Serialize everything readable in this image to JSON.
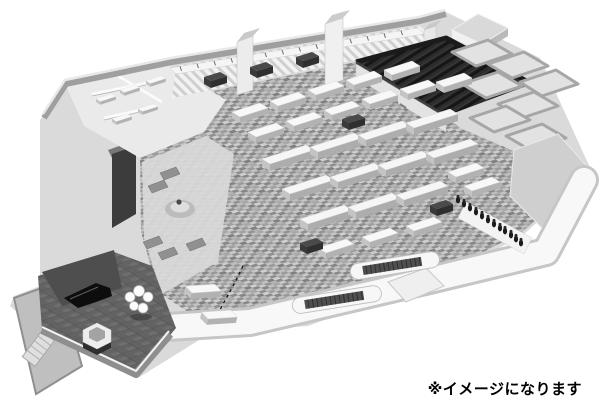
{
  "caption": {
    "text": "※イメージになります"
  },
  "scene": {
    "palette": {
      "background": "#ffffff",
      "base_silhouette": "#dadada",
      "floor_mosaic_base": "#a6a6a6",
      "floor_office": "#eaeaea",
      "floor_lounge": "#d9d9d9",
      "wall_outer": "#9f9f9f",
      "wall_top_highlight": "#e8e8e8",
      "theater_dark": "#2c2c2c",
      "plaza_dark": "#636363",
      "stage_dark": "#4e4e4e",
      "piano_black": "#0d0d0d",
      "walkway_white": "#f8f8f8",
      "walkway_edge": "#c6c6c6",
      "escalator_tread": "#4f4f4f",
      "roof_gray": "#cfcfcf",
      "dark_shelf": "#3c3c3c",
      "ink": "#000000"
    }
  }
}
